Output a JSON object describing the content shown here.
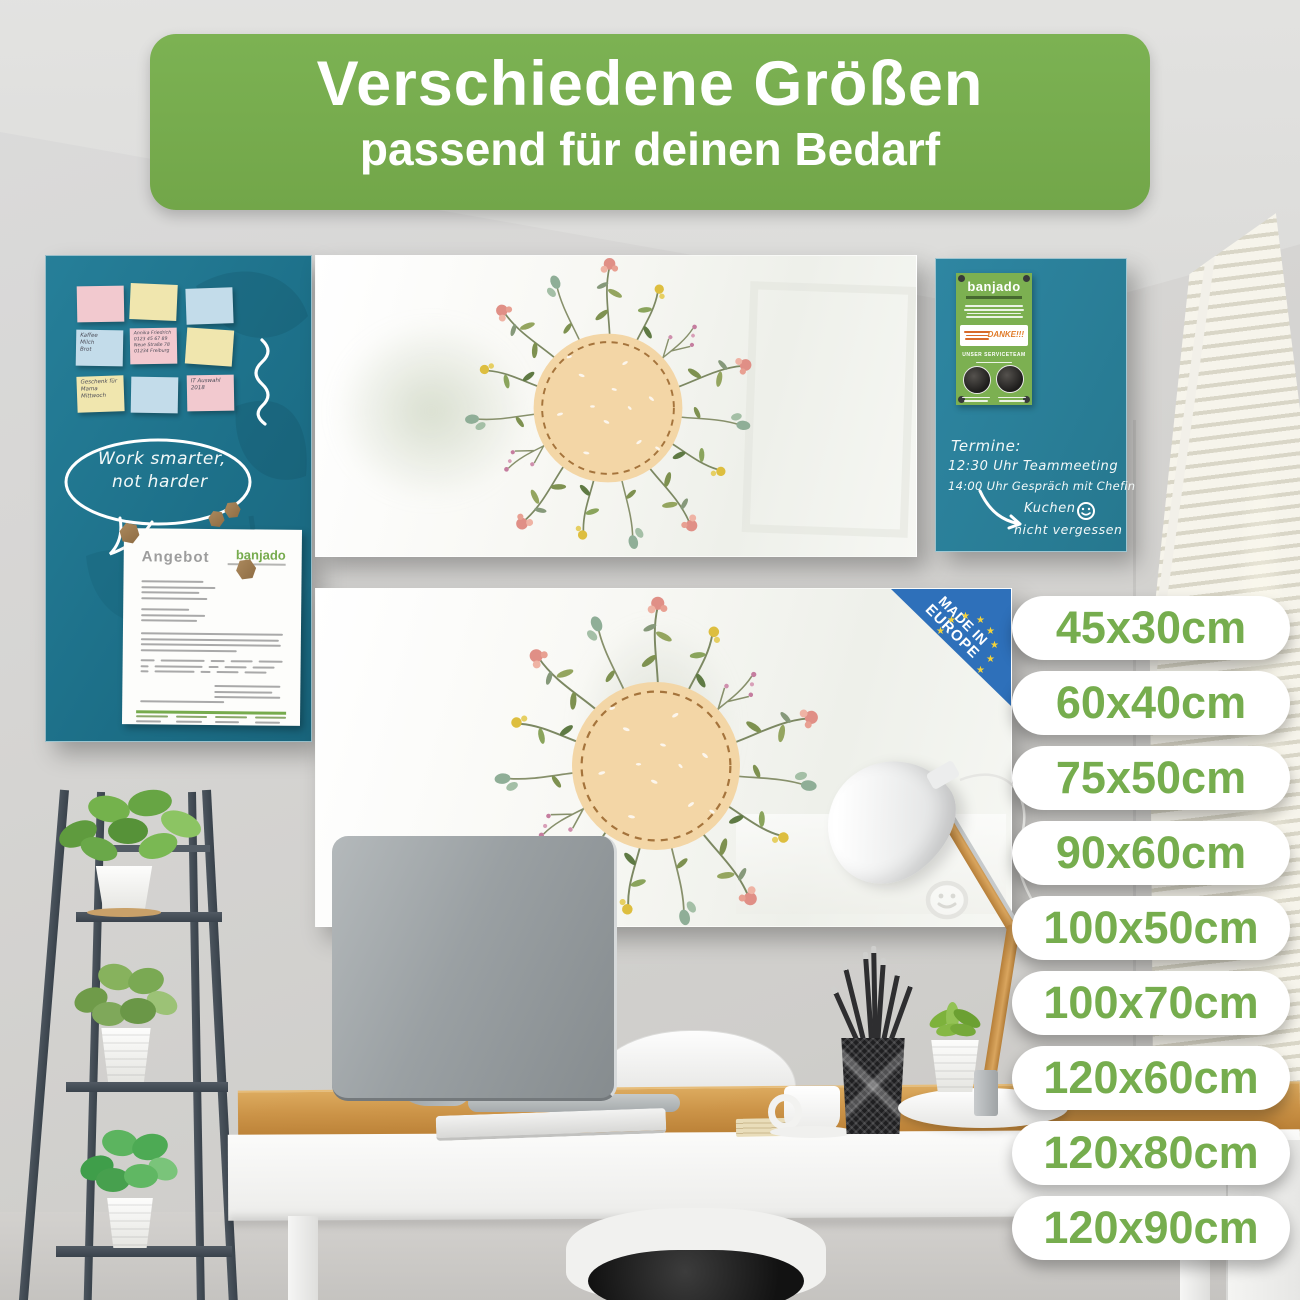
{
  "banner": {
    "title": "Verschiedene Größen",
    "subtitle": "passend für deinen Bedarf"
  },
  "sizes": {
    "items": [
      "45x30cm",
      "60x40cm",
      "75x50cm",
      "90x60cm",
      "100x50cm",
      "100x70cm",
      "120x60cm",
      "120x80cm",
      "120x90cm"
    ]
  },
  "left_board": {
    "speech_bubble": {
      "line1": "Work smarter,",
      "line2": "not harder"
    },
    "notes": [
      {
        "color": "pink",
        "text": ""
      },
      {
        "color": "yellow",
        "text": ""
      },
      {
        "color": "blue",
        "text": ""
      },
      {
        "color": "blue",
        "text": "Kaffee\nMilch\nBrot"
      },
      {
        "color": "pink",
        "text": "Annika Friedrich\n0123 45 67 89\nNeue Straße 78\n01234 Freiburg"
      },
      {
        "color": "yellow",
        "text": ""
      },
      {
        "color": "yellow",
        "text": "Geschenk für\nMama\nMittwoch"
      },
      {
        "color": "blue",
        "text": ""
      },
      {
        "color": "pink",
        "text": "IT Auswahl\n2018"
      }
    ],
    "document": {
      "title": "Angebot",
      "brand": "banjado"
    }
  },
  "right_board": {
    "flyer": {
      "brand": "banjado",
      "thanks": "DANKE!!!",
      "team": "UNSER SERVICETEAM"
    },
    "handwriting": {
      "line1": "Termine:",
      "line2": "12:30 Uhr Teammeeting",
      "line3": "14:00 Uhr Gespräch mit Chefin",
      "reminder1": "Kuchen",
      "reminder2": "nicht vergessen"
    }
  },
  "badge": {
    "line1": "MADE IN",
    "line2": "EUROPE"
  },
  "icons": {
    "star": "★"
  },
  "colors": {
    "accent_green": "#76AB4D",
    "teal_board_left": "#21798F",
    "teal_board_right": "#2C84A0",
    "beige_circle": "#F3D6A6",
    "badge_blue": "#2E70BA"
  }
}
